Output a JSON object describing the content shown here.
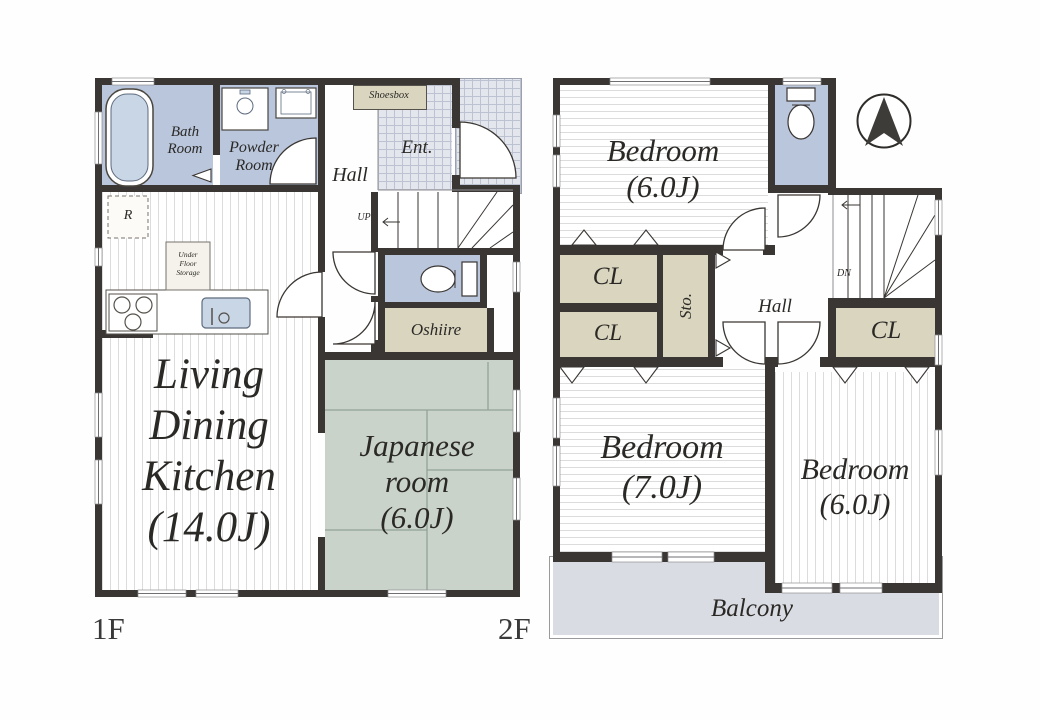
{
  "floor1": {
    "label": "1F",
    "bath_room": [
      "Bath",
      "Room"
    ],
    "powder_room": [
      "Powder",
      "Room"
    ],
    "hall": "Hall",
    "shoesbox": "Shoesbox",
    "entrance": "Ent.",
    "up": "UP",
    "refrigerator": "R",
    "under_floor_storage": [
      "Under",
      "Floor",
      "Storage"
    ],
    "ldk": [
      "Living",
      "Dining",
      "Kitchen",
      "(14.0J)"
    ],
    "oshiire": "Oshiire",
    "japanese_room": [
      "Japanese",
      "room",
      "(6.0J)"
    ]
  },
  "floor2": {
    "label": "2F",
    "bedroom_top": [
      "Bedroom",
      "(6.0J)"
    ],
    "closet1": "CL",
    "closet2": "CL",
    "closet3": "CL",
    "storage": "Sto.",
    "hall": "Hall",
    "down": "DN",
    "bedroom_left": [
      "Bedroom",
      "(7.0J)"
    ],
    "bedroom_right": [
      "Bedroom",
      "(6.0J)"
    ],
    "balcony": "Balcony"
  },
  "compass": {
    "icon": "north-arrow"
  },
  "colors": {
    "wall": "#3a3633",
    "wet_room": "#b9c6dc",
    "tatami": "#c9d3ca",
    "closet": "#dad5bf",
    "balcony": "#d9dce2",
    "tile_line": "#bcc2d2"
  }
}
